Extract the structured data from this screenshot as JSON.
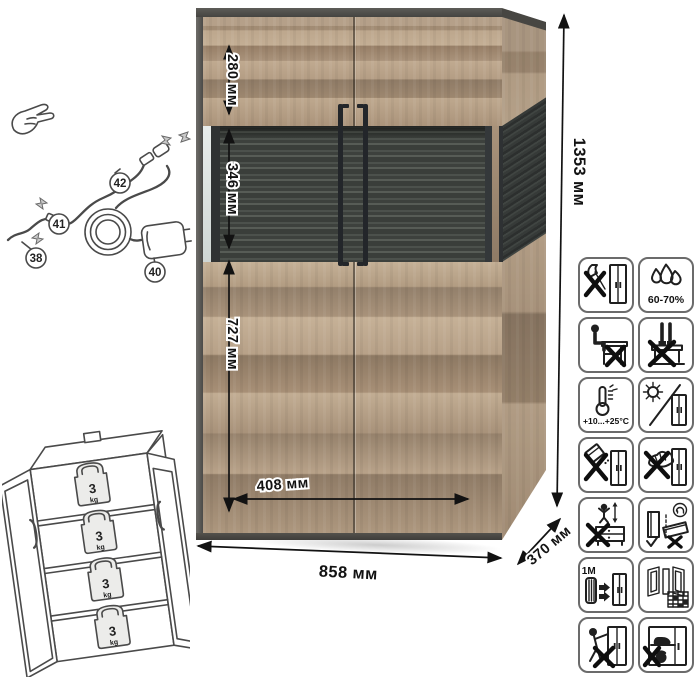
{
  "dimensions": {
    "top_section_height": "280 мм",
    "display_section_height": "346 мм",
    "lower_section_height": "727 мм",
    "door_width": "408 мм",
    "overall_width": "858 мм",
    "overall_depth": "370 мм",
    "overall_height": "1353 мм"
  },
  "connection_diagram": {
    "parts": {
      "led_strip": "38",
      "power_adapter": "40",
      "strip_connector": "41",
      "plug_connector": "42"
    }
  },
  "shelf_load_diagram": {
    "shelves": [
      {
        "value": "3",
        "unit": "kg"
      },
      {
        "value": "3",
        "unit": "kg"
      },
      {
        "value": "3",
        "unit": "kg"
      },
      {
        "value": "3",
        "unit": "kg"
      }
    ]
  },
  "care_icons": [
    {
      "name": "no-impact-tools",
      "label": ""
    },
    {
      "name": "humidity-range",
      "label": "60-70%"
    },
    {
      "name": "no-sitting-on-furniture",
      "label": ""
    },
    {
      "name": "no-standing-on-furniture",
      "label": ""
    },
    {
      "name": "temperature-range",
      "label": "+10...+25°C"
    },
    {
      "name": "avoid-direct-sunlight",
      "label": ""
    },
    {
      "name": "no-abrasive-cleaners",
      "label": ""
    },
    {
      "name": "no-wet-cleaning",
      "label": ""
    },
    {
      "name": "no-children-climbing",
      "label": ""
    },
    {
      "name": "transport-upright-only",
      "label": ""
    },
    {
      "name": "keep-distance-from-heaters",
      "label": "≥1M"
    },
    {
      "name": "ventilated-room",
      "label": ""
    },
    {
      "name": "no-tipping-pulling",
      "label": ""
    },
    {
      "name": "no-heavy-items-inside",
      "label": ""
    }
  ],
  "colors": {
    "wood_light": "#c3ae94",
    "wood_mid": "#ab947b",
    "wood_dark": "#8f7b66",
    "frame_dark": "#4c4b47",
    "glass_back": "#3f433f",
    "handle": "#23262a",
    "line_art": "#4a4a4a",
    "icon_stroke": "#1f1f1f"
  }
}
